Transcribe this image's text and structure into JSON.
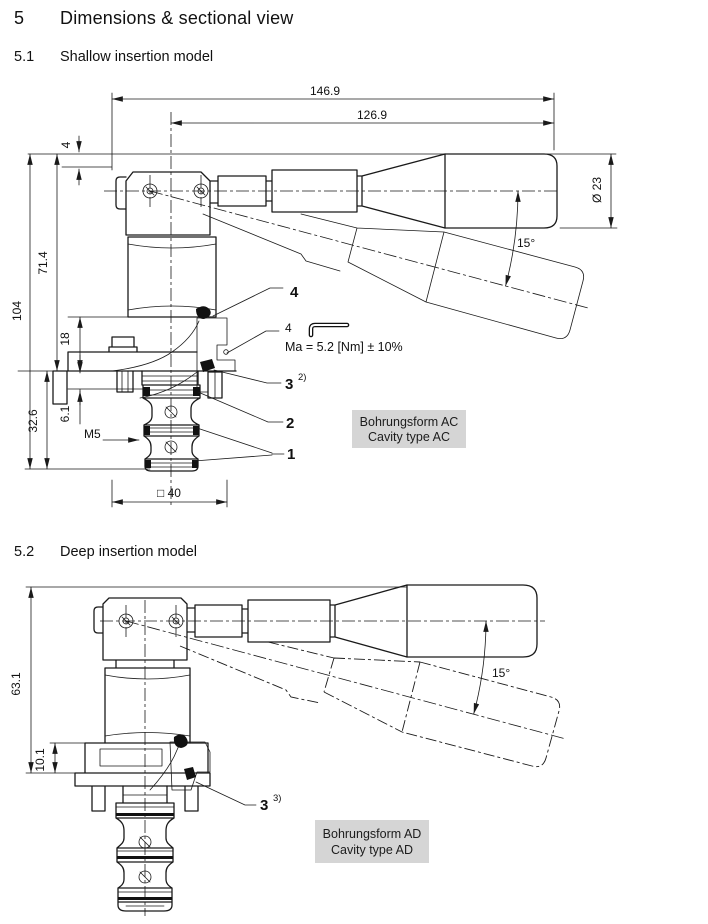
{
  "colors": {
    "line": "#1a1a1a",
    "box_bg": "#d5d5d5"
  },
  "section": {
    "number": "5",
    "title": "Dimensions & sectional view"
  },
  "shallow": {
    "number": "5.1",
    "title": "Shallow insertion model",
    "dims": {
      "d1469": "146.9",
      "d1269": "126.9",
      "dia": "Ø 23",
      "angle": "15°",
      "d4": "4",
      "d714": "71.4",
      "d104": "104",
      "d18": "18",
      "d61": "6.1",
      "d326": "32.6",
      "thread": "M5",
      "square": "□ 40"
    },
    "callouts": {
      "c4": "4",
      "key_size": "4",
      "torque": "Ma = 5.2 [Nm] ± 10%",
      "c3": "3",
      "c3sup": "2)",
      "c2": "2",
      "c1": "1"
    },
    "box": {
      "line1": "Bohrungsform AC",
      "line2": "Cavity type AC"
    }
  },
  "deep": {
    "number": "5.2",
    "title": "Deep insertion model",
    "dims": {
      "d631": "63.1",
      "d101": "10.1",
      "angle": "15°"
    },
    "callouts": {
      "c3": "3",
      "c3sup": "3)"
    },
    "box": {
      "line1": "Bohrungsform AD",
      "line2": "Cavity type AD"
    }
  }
}
